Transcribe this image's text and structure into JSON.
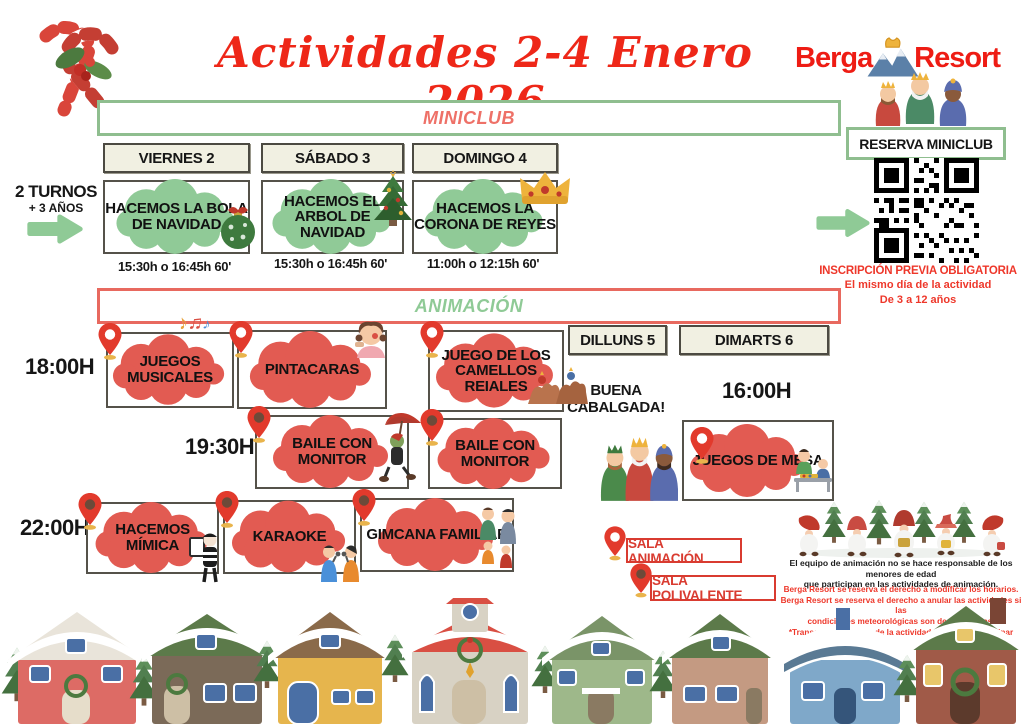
{
  "title": "Actividades 2-4 Enero 2026",
  "brand": {
    "name_left": "Berga",
    "name_right": "Resort"
  },
  "reserva_label": "RESERVA MINICLUB",
  "inscripcion": {
    "line1": "INSCRIPCIÓN PREVIA OBLIGATORIA",
    "line2": "El mismo día de la actividad",
    "line3": "De 3 a 12 años"
  },
  "miniclub": {
    "header": "MINICLUB",
    "turnos_line1": "2 TURNOS",
    "turnos_line2": "+ 3 AÑOS",
    "days": [
      {
        "label": "VIERNES 2"
      },
      {
        "label": "SÁBADO 3"
      },
      {
        "label": "DOMINGO 4"
      }
    ],
    "activities": [
      {
        "title": "HACEMOS LA BOLA DE NAVIDAD",
        "time": "15:30h o 16:45h 60'",
        "icon": "christmas-ornament"
      },
      {
        "title": "HACEMOS EL ARBOL DE NAVIDAD",
        "time": "15:30h o 16:45h 60'",
        "icon": "christmas-tree"
      },
      {
        "title": "HACEMOS LA CORONA DE REYES",
        "time": "11:00h o 12:15h 60'",
        "icon": "kings-crown"
      }
    ]
  },
  "animacion": {
    "header": "ANIMACIÓN",
    "extra_days": [
      {
        "label": "DILLUNS 5"
      },
      {
        "label": "DIMARTS 6"
      }
    ],
    "times": {
      "t1800": "18:00H",
      "t1930": "19:30H",
      "t2200": "22:00H",
      "t1600": "16:00H"
    },
    "cabalgada_line1": "BUENA",
    "cabalgada_line2": "CABALGADA!",
    "activities": {
      "juegos_musicales": {
        "title": "JUEGOS MUSICALES",
        "room": "SALA ANIMACIÓN",
        "icon": "music-notes"
      },
      "pintacaras": {
        "title": "PINTACARAS",
        "room": "SALA ANIMACIÓN",
        "icon": "face-painting-girl"
      },
      "camellos": {
        "title": "JUEGO DE LOS CAMELLOS REIALES",
        "room": "SALA ANIMACIÓN",
        "icon": "kings-on-camels"
      },
      "baile1": {
        "title": "BAILE CON MONITOR",
        "room": "SALA POLIVALENTE",
        "icon": "cricket-with-umbrella"
      },
      "baile2": {
        "title": "BAILE CON MONITOR",
        "room": "SALA POLIVALENTE"
      },
      "mimica": {
        "title": "HACEMOS MÍMICA",
        "room": "SALA POLIVALENTE",
        "icon": "mime"
      },
      "karaoke": {
        "title": "KARAOKE",
        "room": "SALA POLIVALENTE",
        "icon": "singing-kids"
      },
      "gimcana": {
        "title": "GIMCANA FAMILIAR",
        "room": "SALA POLIVALENTE",
        "icon": "family"
      },
      "juegos_mesa": {
        "title": "JUEGOS DE MESA",
        "room": "SALA ANIMACIÓN",
        "icon": "kids-board-game"
      }
    }
  },
  "legend": {
    "sala_animacion": "SALA ANIMACIÓN",
    "sala_polivalente": "SALA POLIVALENTE"
  },
  "disclaimer": {
    "black_line1": "El equipo de animación no se hace responsable de los menores de edad",
    "black_line2": "que participan en las actividades de animación.",
    "red_line1": "Berga Resort se reserva el derecho a modificar los horarios.",
    "red_line2": "Berga Resort se reserva el derecho a anular las actividades si las",
    "red_line3": "condiciones meteorológicas son desfavorables.",
    "red_line4": "*Transcurridos 10min de la actividad no podrán participar"
  },
  "colors": {
    "title_red": "#ee2718",
    "cloud_green": "#90ca97",
    "cloud_red": "#e25b52",
    "bar_border_green": "#8fbe8f",
    "bar_border_red": "#e8695f",
    "bar_text_salmon": "#ee7168",
    "bar_text_green": "#8fca96",
    "day_box_beige": "#f1f0e2",
    "pin_red": "#e23a2c",
    "pin_dark_center": "#6d4a39",
    "legend_red": "#d93b30"
  }
}
